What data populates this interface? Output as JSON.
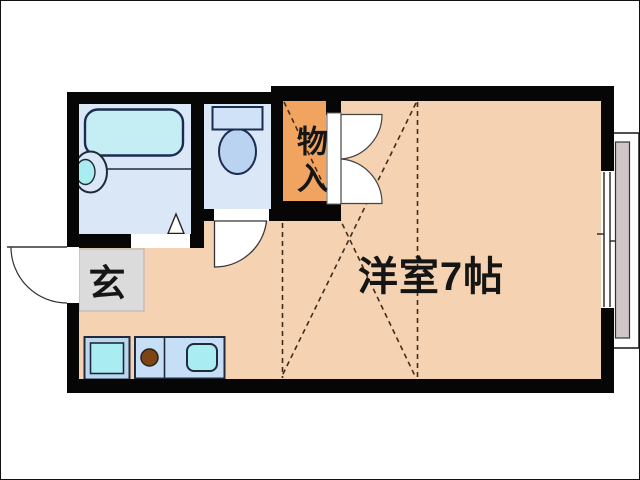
{
  "floorplan": {
    "labels": {
      "main_room": "洋室7帖",
      "storage": "物入",
      "entrance": "玄"
    },
    "rooms": [
      {
        "name": "western-room",
        "label": "洋室7帖",
        "size_tatami": "7帖"
      },
      {
        "name": "storage-closet",
        "label": "物入"
      },
      {
        "name": "entrance",
        "label": "玄"
      },
      {
        "name": "bathroom"
      },
      {
        "name": "toilet"
      },
      {
        "name": "kitchen-area"
      },
      {
        "name": "balcony"
      }
    ],
    "fixtures": [
      "bathtub",
      "washbasin",
      "toilet",
      "sink",
      "gas-burner",
      "washing-machine-pan",
      "sliding-window",
      "balcony",
      "entrance-door",
      "bathroom-door",
      "toilet-door",
      "storage-double-door"
    ],
    "colors": {
      "room_floor": "#f5d3b2",
      "wet_area_floor": "#d9e7f7",
      "storage_floor": "#f1a360",
      "entrance_floor": "#dbdbdb",
      "bathtub_fill": "#c4eef4",
      "fixture_fill": "#a9edf3",
      "counter_fill": "#c6dff6",
      "tank_fill": "#cfe2f7",
      "bowl_fill": "#b9d3f1",
      "pan_frame_fill": "#b9d8f0",
      "burner_color": "#7c4513",
      "balcony_floor": "#cfc7c7",
      "wall_color": "#060606",
      "dashed_line_color": "#3f2d1c"
    }
  }
}
